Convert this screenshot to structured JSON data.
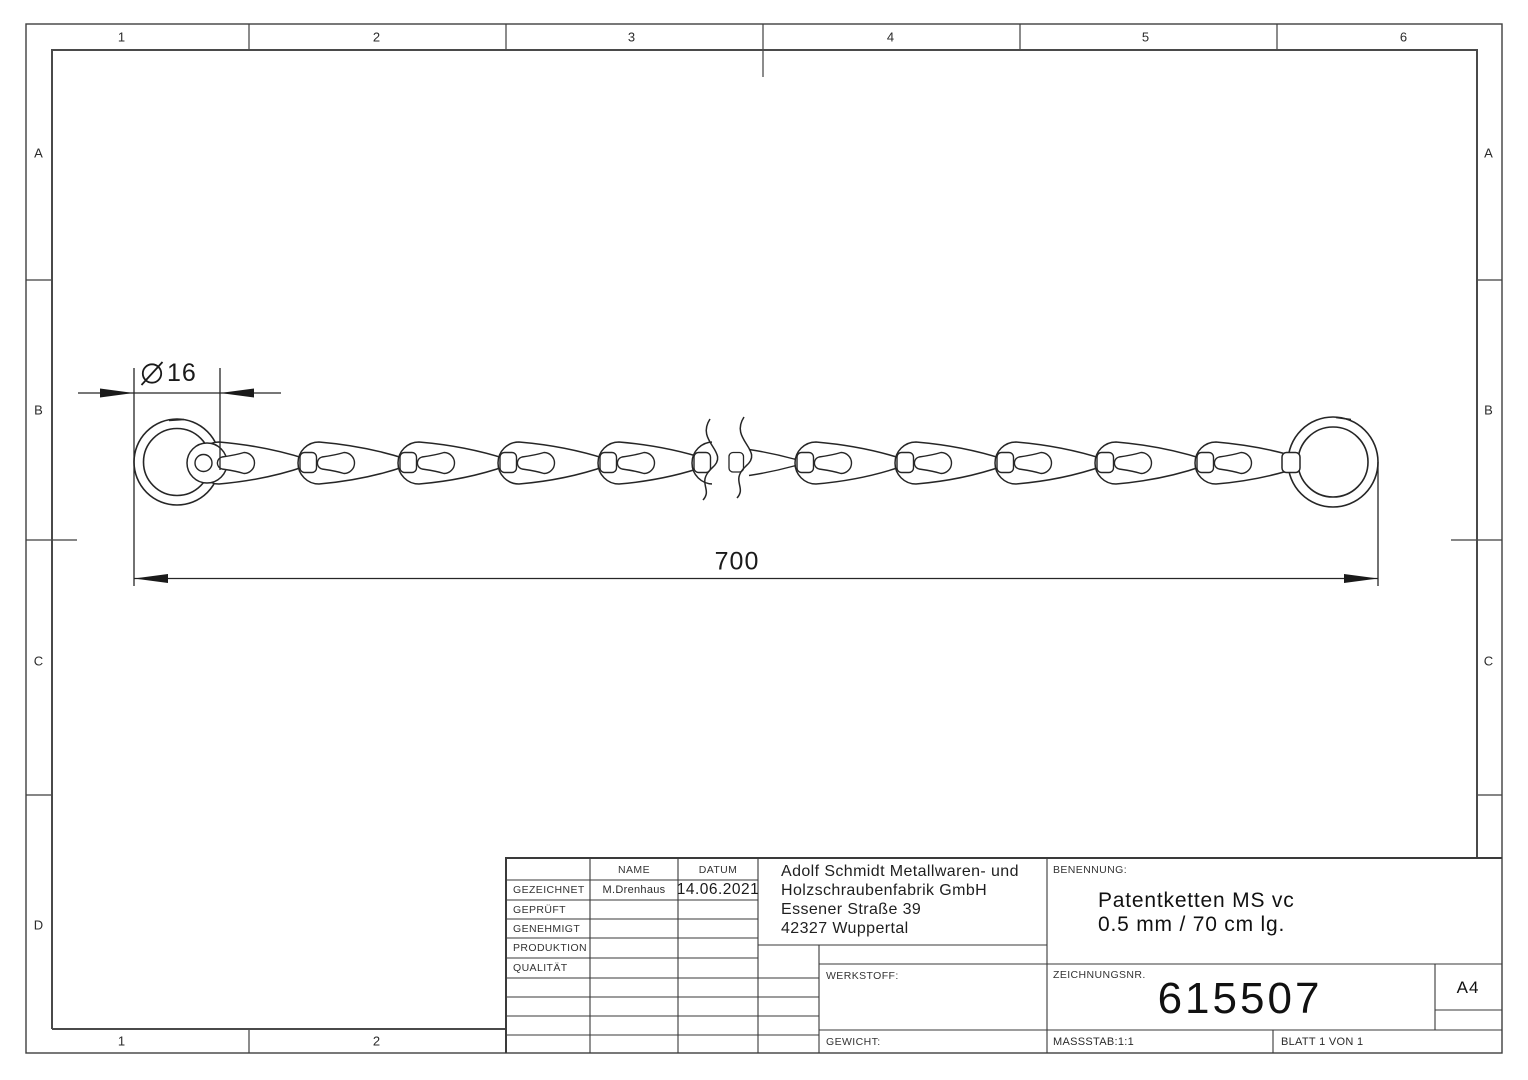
{
  "frame": {
    "columns": [
      "1",
      "2",
      "3",
      "4",
      "5",
      "6"
    ],
    "bottom_columns": [
      "1",
      "2"
    ],
    "rows_left": [
      "A",
      "B",
      "C",
      "D"
    ],
    "rows_right": [
      "A",
      "B",
      "C"
    ]
  },
  "dimensions": {
    "ring_diameter": "16",
    "chain_length": "700"
  },
  "title_block": {
    "name_header": "NAME",
    "date_header": "DATUM",
    "rows": [
      {
        "label": "GEZEICHNET",
        "name": "M.Drenhaus",
        "date": "14.06.2021"
      },
      {
        "label": "GEPRÜFT"
      },
      {
        "label": "GENEHMIGT"
      },
      {
        "label": "PRODUKTION"
      },
      {
        "label": "QUALITÄT"
      }
    ],
    "company_lines": [
      "Adolf Schmidt Metallwaren- und",
      "Holzschraubenfabrik GmbH",
      "Essener Straße 39",
      "42327 Wuppertal"
    ],
    "benennung_label": "BENENNUNG:",
    "title_lines": [
      "Patentketten MS vc",
      "0.5 mm / 70 cm lg."
    ],
    "werkstoff_label": "WERKSTOFF:",
    "gewicht_label": "GEWICHT:",
    "zeichnungsnr_label": "ZEICHNUNGSNR.",
    "drawing_number": "615507",
    "paper_size": "A4",
    "massstab": "MASSSTAB:1:1",
    "blatt": "BLATT 1 VON 1"
  },
  "colors": {
    "line": "#262626",
    "frame_line": "#3f3f3f"
  }
}
